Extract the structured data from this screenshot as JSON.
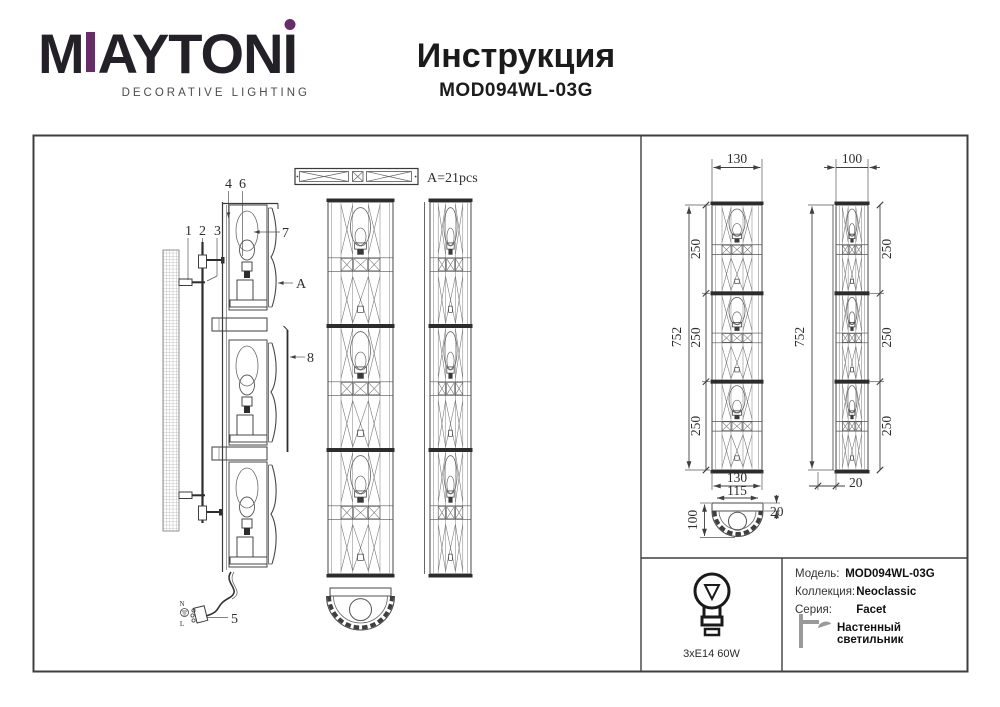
{
  "brand": {
    "wordmark_m": "M",
    "wordmark_rest": "AYTON",
    "wordmark_i": "I",
    "tagline": "DECORATIVE LIGHTING",
    "accent_color": "#662d69",
    "letter_color": "#232127"
  },
  "header": {
    "title": "Инструкция",
    "model": "MOD094WL-03G"
  },
  "drawing": {
    "crystal_count_label": "A=21pcs",
    "part_labels": {
      "p1": "1",
      "p2": "2",
      "p3": "3",
      "p4": "4",
      "p5": "5",
      "p6": "6",
      "p7": "7",
      "p8": "8",
      "pA": "A"
    },
    "wiring_labels": {
      "n": "N",
      "l": "L"
    },
    "dimensions": {
      "w130": "130",
      "w100": "100",
      "h752": "752",
      "s250": "250",
      "w115": "115",
      "t20": "20"
    }
  },
  "info_box": {
    "lamp_spec": "3xE14 60W",
    "fields": [
      {
        "label": "Модель:",
        "value": "MOD094WL-03G"
      },
      {
        "label": "Коллекция:",
        "value": "Neoclassic"
      },
      {
        "label": "Серия:",
        "value": "Facet"
      }
    ],
    "type_label": "Настенный светильник"
  }
}
